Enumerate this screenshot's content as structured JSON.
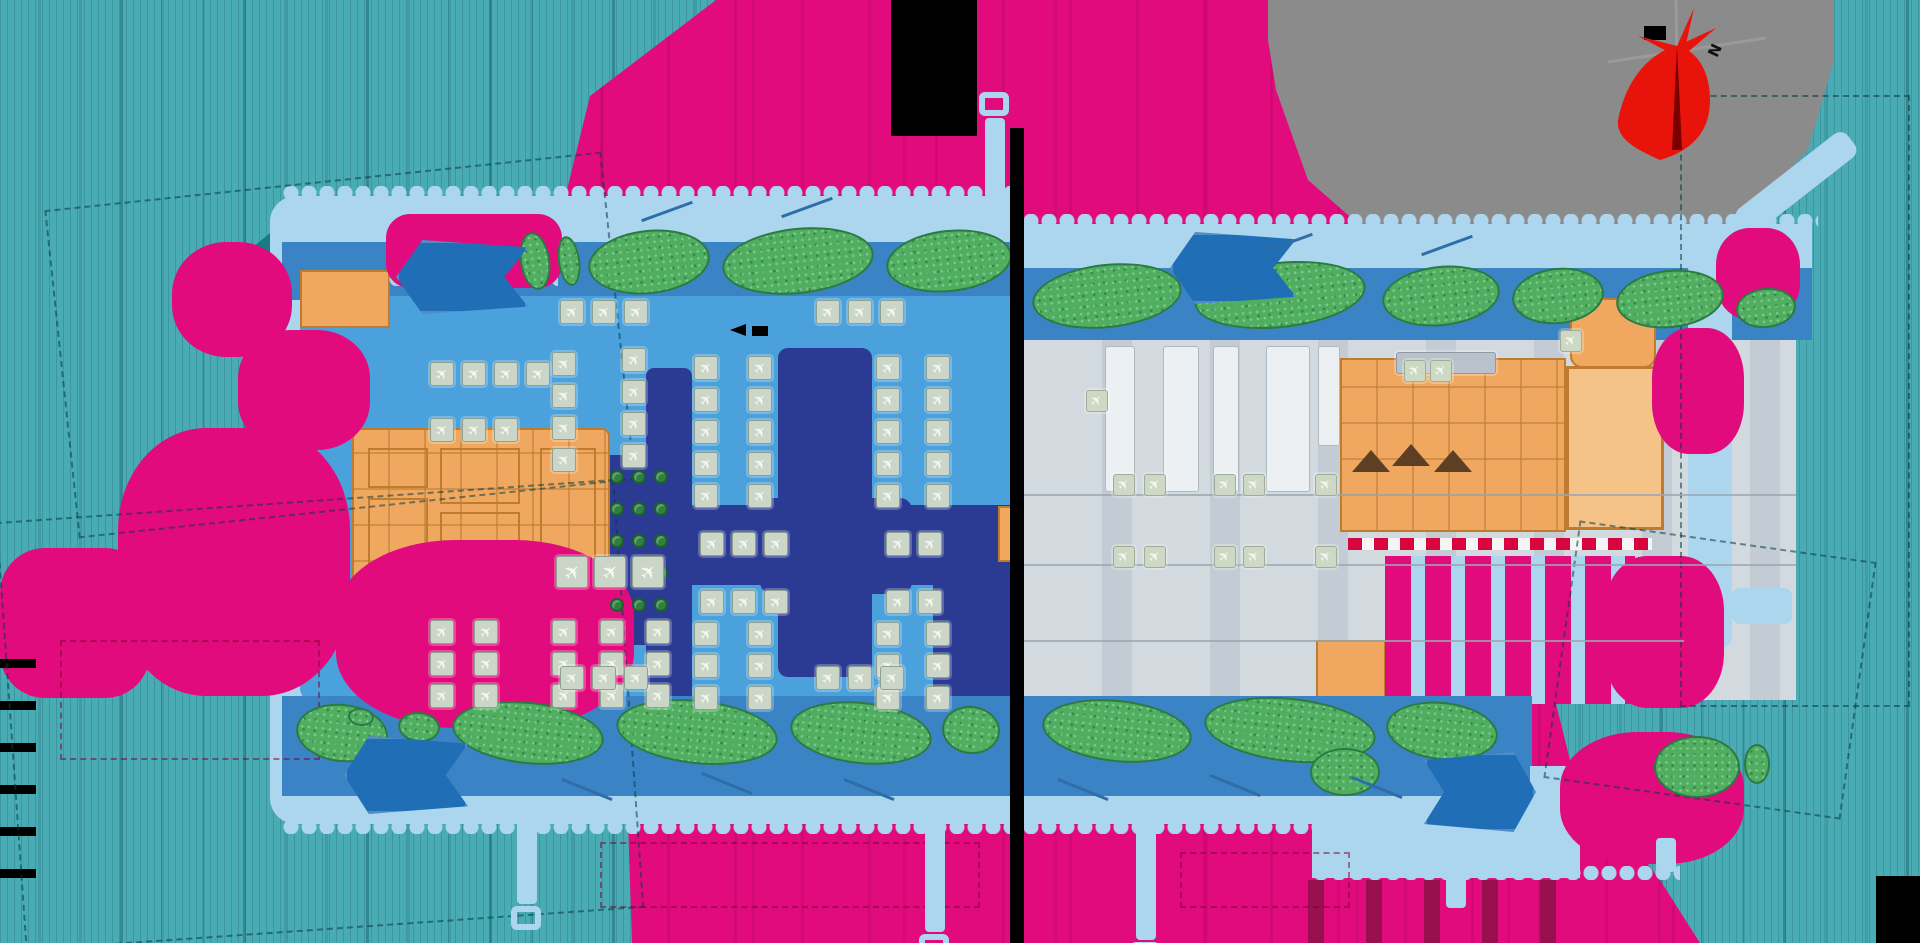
{
  "title": "airport-terminal-master-plan-map",
  "palette": {
    "magenta": "#e20b7d",
    "crimson": "#99104f",
    "teal": "#49abb4",
    "tealDark": "#157c86",
    "pale": "#abd6ee",
    "road": "#3a83c5",
    "plaza": "#1f6eb6",
    "apron": "#4aa1dc",
    "navy": "#2b3a92",
    "sage": "#ccd6c8",
    "sageEdge": "#8fa291",
    "planeWhite": "#f6f8f4",
    "lawn": "#4fae5f",
    "lawnEdge": "#2c7a42",
    "tree": "#2f8040",
    "orange": "#f0a860",
    "orangeLine": "#c07c2e",
    "orangeLight": "#f5c288",
    "grayApron": "#c3ccd4",
    "grayApronLight": "#d2d9df",
    "slabWhite": "#edf0f3",
    "seam": "#9aa7b0",
    "blobGray": "#8b8b8b",
    "red": "#e8140b",
    "black": "#000000",
    "dashRed": "#d8063e",
    "dashWhite": "#f5f5f5"
  },
  "compass": {
    "north_label": "N"
  },
  "icons": {
    "gate_stand": "✈",
    "tree": "tree-icon",
    "lawn": "lawn-patch"
  },
  "features": {
    "magenta_blobs": [
      {
        "x": 172,
        "y": 242,
        "w": 120,
        "h": 115,
        "r": "45%"
      },
      {
        "x": 238,
        "y": 330,
        "w": 132,
        "h": 120,
        "r": "40%"
      },
      {
        "x": 118,
        "y": 428,
        "w": 232,
        "h": 268,
        "r": "38%"
      },
      {
        "x": 0,
        "y": 548,
        "w": 150,
        "h": 150,
        "r": "30%"
      },
      {
        "x": 336,
        "y": 540,
        "w": 298,
        "h": 188,
        "r": "40%"
      },
      {
        "x": 386,
        "y": 214,
        "w": 176,
        "h": 74,
        "r": "24px"
      },
      {
        "x": 1716,
        "y": 228,
        "w": 84,
        "h": 92,
        "r": "40%"
      },
      {
        "x": 1652,
        "y": 328,
        "w": 92,
        "h": 126,
        "r": "40%"
      },
      {
        "x": 1560,
        "y": 732,
        "w": 184,
        "h": 132,
        "r": "42%"
      },
      {
        "x": 1604,
        "y": 556,
        "w": 120,
        "h": 152,
        "r": "36%"
      }
    ],
    "lawns": [
      {
        "x": 520,
        "y": 232,
        "w": 30,
        "h": 58,
        "rot": -8
      },
      {
        "x": 558,
        "y": 236,
        "w": 22,
        "h": 50,
        "rot": -8
      },
      {
        "x": 588,
        "y": 230,
        "w": 122,
        "h": 64,
        "rot": -6
      },
      {
        "x": 722,
        "y": 228,
        "w": 152,
        "h": 66,
        "rot": -6
      },
      {
        "x": 886,
        "y": 230,
        "w": 126,
        "h": 62,
        "rot": -6
      },
      {
        "x": 1032,
        "y": 264,
        "w": 150,
        "h": 64,
        "rot": -6
      },
      {
        "x": 1194,
        "y": 262,
        "w": 172,
        "h": 66,
        "rot": -6
      },
      {
        "x": 1382,
        "y": 266,
        "w": 118,
        "h": 60,
        "rot": -6
      },
      {
        "x": 1512,
        "y": 268,
        "w": 92,
        "h": 56,
        "rot": -6
      },
      {
        "x": 1616,
        "y": 270,
        "w": 108,
        "h": 58,
        "rot": -6
      },
      {
        "x": 1736,
        "y": 288,
        "w": 60,
        "h": 40,
        "rot": -6
      },
      {
        "x": 296,
        "y": 704,
        "w": 92,
        "h": 58,
        "rot": 6
      },
      {
        "x": 348,
        "y": 708,
        "w": 26,
        "h": 18,
        "rot": 6
      },
      {
        "x": 398,
        "y": 712,
        "w": 42,
        "h": 30,
        "rot": 6
      },
      {
        "x": 452,
        "y": 702,
        "w": 152,
        "h": 62,
        "rot": 6
      },
      {
        "x": 616,
        "y": 700,
        "w": 162,
        "h": 64,
        "rot": 6
      },
      {
        "x": 790,
        "y": 702,
        "w": 142,
        "h": 62,
        "rot": 6
      },
      {
        "x": 942,
        "y": 706,
        "w": 58,
        "h": 48,
        "rot": 6
      },
      {
        "x": 1042,
        "y": 700,
        "w": 150,
        "h": 62,
        "rot": 6
      },
      {
        "x": 1204,
        "y": 698,
        "w": 172,
        "h": 64,
        "rot": 6
      },
      {
        "x": 1386,
        "y": 702,
        "w": 112,
        "h": 58,
        "rot": 6
      },
      {
        "x": 1310,
        "y": 748,
        "w": 70,
        "h": 48,
        "rot": 0
      },
      {
        "x": 1654,
        "y": 736,
        "w": 86,
        "h": 62,
        "rot": 0
      },
      {
        "x": 1744,
        "y": 744,
        "w": 26,
        "h": 40,
        "rot": 0
      }
    ],
    "trees": [
      {
        "x": 610,
        "y": 470
      },
      {
        "x": 632,
        "y": 470
      },
      {
        "x": 654,
        "y": 470
      },
      {
        "x": 610,
        "y": 502
      },
      {
        "x": 632,
        "y": 502
      },
      {
        "x": 654,
        "y": 502
      },
      {
        "x": 610,
        "y": 534
      },
      {
        "x": 632,
        "y": 534
      },
      {
        "x": 654,
        "y": 534
      },
      {
        "x": 610,
        "y": 566
      },
      {
        "x": 632,
        "y": 566
      },
      {
        "x": 654,
        "y": 566
      },
      {
        "x": 610,
        "y": 598
      },
      {
        "x": 632,
        "y": 598
      },
      {
        "x": 654,
        "y": 598
      }
    ],
    "gate_cols": [
      {
        "x": 694,
        "y": 356,
        "n": 5
      },
      {
        "x": 748,
        "y": 356,
        "n": 5
      },
      {
        "x": 876,
        "y": 356,
        "n": 5
      },
      {
        "x": 926,
        "y": 356,
        "n": 5
      },
      {
        "x": 552,
        "y": 352,
        "n": 4
      },
      {
        "x": 622,
        "y": 348,
        "n": 4
      },
      {
        "x": 694,
        "y": 622,
        "n": 3
      },
      {
        "x": 748,
        "y": 622,
        "n": 3
      },
      {
        "x": 876,
        "y": 622,
        "n": 3
      },
      {
        "x": 926,
        "y": 622,
        "n": 3
      },
      {
        "x": 430,
        "y": 620,
        "n": 3
      },
      {
        "x": 474,
        "y": 620,
        "n": 3
      },
      {
        "x": 552,
        "y": 620,
        "n": 3
      },
      {
        "x": 600,
        "y": 620,
        "n": 3
      },
      {
        "x": 646,
        "y": 620,
        "n": 3
      }
    ],
    "gate_rows": [
      {
        "x": 430,
        "y": 362,
        "n": 4
      },
      {
        "x": 430,
        "y": 418,
        "n": 3
      },
      {
        "x": 560,
        "y": 300,
        "n": 3
      },
      {
        "x": 816,
        "y": 300,
        "n": 3
      },
      {
        "x": 700,
        "y": 532,
        "n": 3
      },
      {
        "x": 886,
        "y": 532,
        "n": 2
      },
      {
        "x": 700,
        "y": 590,
        "n": 3
      },
      {
        "x": 886,
        "y": 590,
        "n": 2
      },
      {
        "x": 560,
        "y": 666,
        "n": 3
      },
      {
        "x": 816,
        "y": 666,
        "n": 3
      }
    ],
    "big_gate_rows": [
      {
        "x": 556,
        "y": 556,
        "n": 3,
        "size": 32
      }
    ],
    "pads_right": [
      {
        "x": 1113,
        "y": 474
      },
      {
        "x": 1144,
        "y": 474
      },
      {
        "x": 1214,
        "y": 474
      },
      {
        "x": 1243,
        "y": 474
      },
      {
        "x": 1315,
        "y": 474
      },
      {
        "x": 1113,
        "y": 546
      },
      {
        "x": 1144,
        "y": 546
      },
      {
        "x": 1214,
        "y": 546
      },
      {
        "x": 1243,
        "y": 546
      },
      {
        "x": 1315,
        "y": 546
      },
      {
        "x": 1086,
        "y": 390
      },
      {
        "x": 1404,
        "y": 360
      },
      {
        "x": 1430,
        "y": 360
      },
      {
        "x": 1560,
        "y": 330
      }
    ],
    "white_slabs": [
      {
        "x": 1105,
        "y": 346,
        "w": 30,
        "h": 146
      },
      {
        "x": 1163,
        "y": 346,
        "w": 36,
        "h": 146
      },
      {
        "x": 1213,
        "y": 346,
        "w": 26,
        "h": 146
      },
      {
        "x": 1266,
        "y": 346,
        "w": 44,
        "h": 146
      },
      {
        "x": 1318,
        "y": 346,
        "w": 22,
        "h": 100
      }
    ],
    "seams": [
      {
        "x": 1024,
        "y": 494,
        "w": 772
      },
      {
        "x": 1024,
        "y": 564,
        "w": 772
      },
      {
        "x": 1024,
        "y": 640,
        "w": 660
      }
    ],
    "bridges": [
      {
        "x": 560,
        "y": 788,
        "rot": 22
      },
      {
        "x": 700,
        "y": 782,
        "rot": 22
      },
      {
        "x": 842,
        "y": 788,
        "rot": 22
      },
      {
        "x": 1056,
        "y": 788,
        "rot": 22
      },
      {
        "x": 1208,
        "y": 784,
        "rot": 22
      },
      {
        "x": 1350,
        "y": 786,
        "rot": 22
      },
      {
        "x": 640,
        "y": 210,
        "rot": -20
      },
      {
        "x": 780,
        "y": 206,
        "rot": -20
      },
      {
        "x": 1260,
        "y": 242,
        "rot": -20
      },
      {
        "x": 1420,
        "y": 244,
        "rot": -20
      }
    ],
    "guides": [
      {
        "x": 10,
        "y": 500,
        "w": 620,
        "h": 430,
        "rot": -4
      },
      {
        "x": 60,
        "y": 180,
        "w": 560,
        "h": 330,
        "rot": -6
      },
      {
        "x": 1680,
        "y": 95,
        "w": 230,
        "h": 612,
        "rot": 0
      },
      {
        "x": 1560,
        "y": 540,
        "w": 300,
        "h": 260,
        "rot": 8
      }
    ],
    "marks": [
      {
        "x": 600,
        "y": 842,
        "w": 380,
        "h": 66
      },
      {
        "x": 1180,
        "y": 852,
        "w": 170,
        "h": 56
      },
      {
        "x": 60,
        "y": 640,
        "w": 260,
        "h": 120
      }
    ],
    "arrows": [
      {
        "x": 396,
        "y": 240,
        "w": 132,
        "h": 74,
        "dir": "left"
      },
      {
        "x": 1170,
        "y": 232,
        "w": 126,
        "h": 72,
        "dir": "left"
      },
      {
        "x": 344,
        "y": 736,
        "w": 124,
        "h": 78,
        "dir": "left"
      },
      {
        "x": 1424,
        "y": 752,
        "w": 112,
        "h": 80,
        "dir": "right"
      }
    ],
    "avenues": [
      {
        "x": 985,
        "y": 118,
        "h": 80,
        "cap": "top"
      },
      {
        "x": 517,
        "y": 820,
        "h": 84,
        "cap": "bottom"
      },
      {
        "x": 925,
        "y": 820,
        "h": 112,
        "cap": "bottom"
      },
      {
        "x": 1136,
        "y": 820,
        "h": 120,
        "cap": "bottom"
      },
      {
        "x": 1446,
        "y": 838,
        "h": 70,
        "cap": "none"
      },
      {
        "x": 1656,
        "y": 838,
        "h": 34,
        "cap": "none"
      }
    ],
    "cargo_triangles": [
      {
        "x": 1352,
        "y": 450
      },
      {
        "x": 1392,
        "y": 444
      },
      {
        "x": 1434,
        "y": 450
      }
    ]
  }
}
